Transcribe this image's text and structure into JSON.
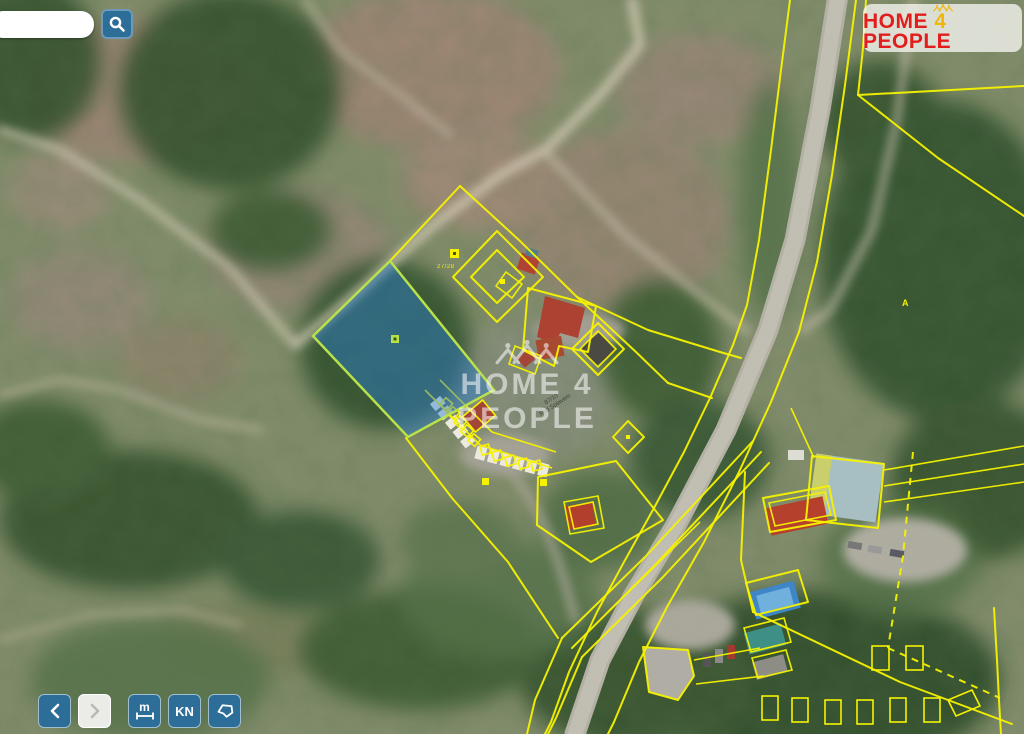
{
  "theme": {
    "accent_yellow": "#f7f200",
    "parcel_fill": "#2a7fd4",
    "parcel_stroke": "#b9e14a",
    "button_blue": "#2d6e99",
    "button_disabled_bg": "#ebebe8",
    "logo_red": "#e21d1d",
    "logo_gold": "#f2b705",
    "watermark_color": "rgba(255,255,255,0.55)"
  },
  "search": {
    "value": "",
    "placeholder": ""
  },
  "logo": {
    "word1": "HOME",
    "word2": "4",
    "word3": "PEOPLE"
  },
  "watermark": {
    "text": "HOME 4 PEOPLE"
  },
  "toolbar": {
    "measure_label": "m",
    "kn_label": "KN"
  },
  "map_labels": {
    "parcel_number": "27/28",
    "street_parcel_number": "87/10",
    "street_name": "Pod Splavem",
    "poi_label": "A"
  }
}
